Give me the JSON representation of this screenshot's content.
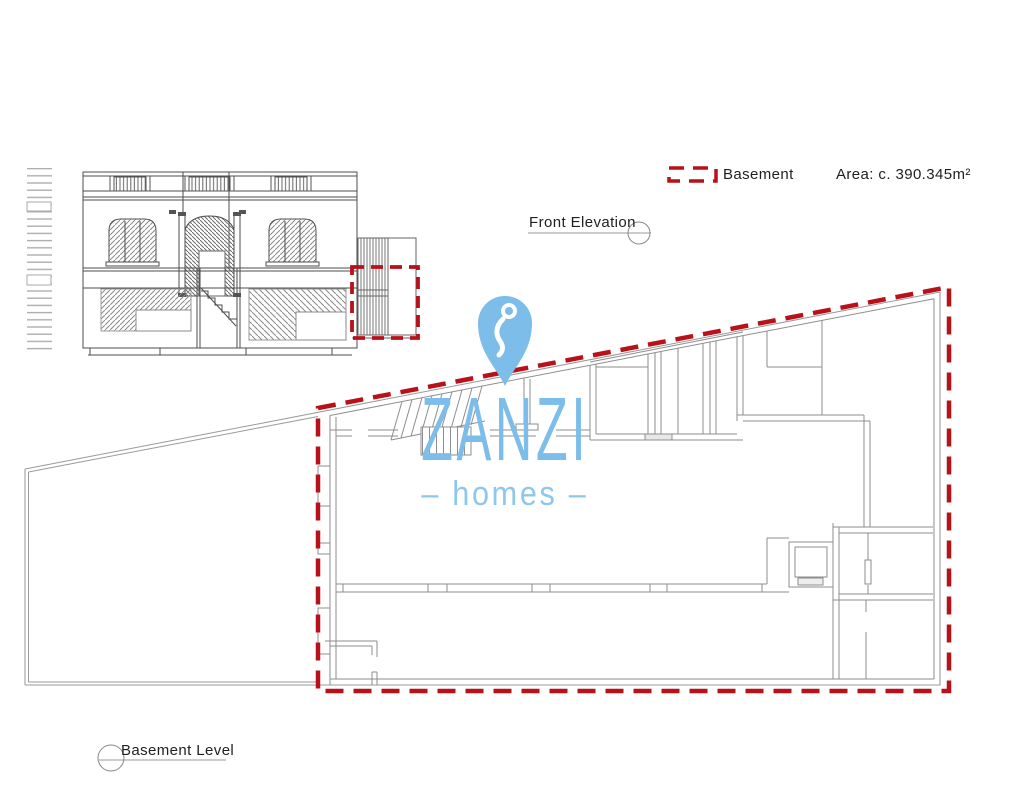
{
  "page": {
    "background": "#ffffff"
  },
  "legend": {
    "swatch": {
      "label": "Basement",
      "color": "#b8111a",
      "style": "dashed-outline"
    },
    "area": "Area: c. 390.345m²"
  },
  "callouts": {
    "front_elevation": "Front Elevation",
    "basement_level": "Basement Level"
  },
  "logo": {
    "brand": "ZANZI",
    "tagline": "– homes –",
    "pin_icon": "location-pin",
    "color_primary": "#7cbde9",
    "color_secondary": "#8fc6ec"
  },
  "colors": {
    "highlight_red": "#b8111a",
    "plan_line_gray": "#8e8e8e",
    "elevation_line_gray": "#4d4d4d"
  }
}
